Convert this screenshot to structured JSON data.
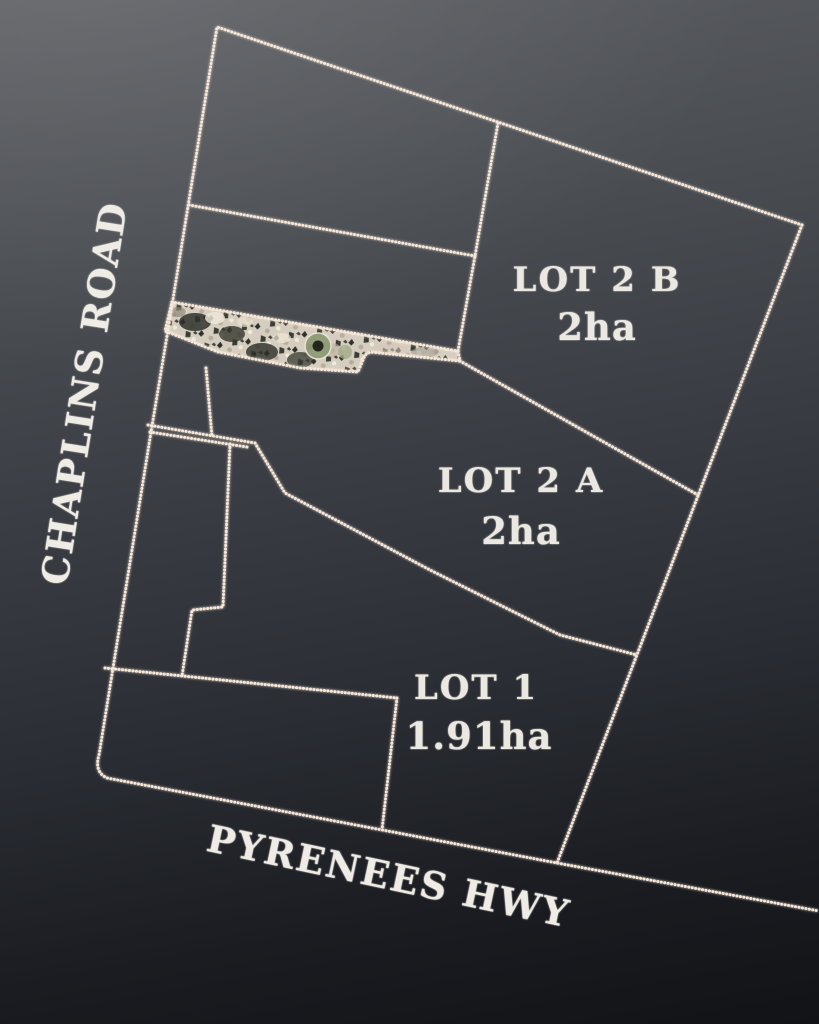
{
  "plan": {
    "title": "Land subdivision site plan",
    "roads": [
      {
        "name": "CHAPLINS ROAD",
        "side": "west"
      },
      {
        "name": "PYRENEES HWY",
        "side": "south"
      }
    ],
    "lots": [
      {
        "name": "LOT 2 B",
        "area": "2ha"
      },
      {
        "name": "LOT 2 A",
        "area": "2ha"
      },
      {
        "name": "LOT 1",
        "area": "1.91ha"
      }
    ],
    "colors": {
      "boundary_line": "#f6e7d9",
      "label_text": "#ebe8e1",
      "background_top": "#5d5f63",
      "background_bottom": "#111316",
      "aerial_strip_base": "#d5cdbf"
    }
  }
}
